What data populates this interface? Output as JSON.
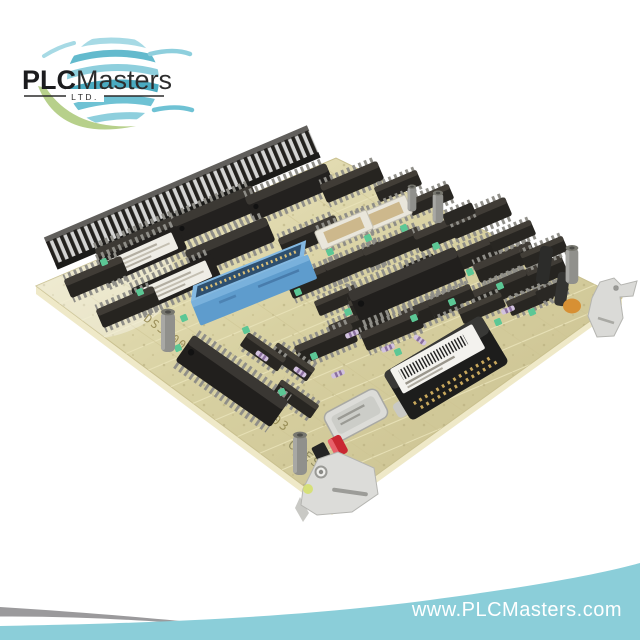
{
  "brand": {
    "logo": {
      "text_bold": "PLC",
      "text_regular": "Masters",
      "suffix": "LTD."
    },
    "website": "www.PLCMasters.com"
  },
  "board": {
    "markings": {
      "part_number": "DS3800HMPJ1A1D",
      "slot_code": "6BA03",
      "group_code": "C-ESS"
    }
  },
  "colors": {
    "background": "#ffffff",
    "banner_teal": "#8bced9",
    "swoosh_gray": "#9b9a9c",
    "logo_teal": "#63bacd",
    "logo_teal_light": "#a7dae5",
    "logo_teal_deep": "#4aabc1",
    "leaf_green": "#b7d08b",
    "logo_text": "#1d1d1f",
    "url_text": "#ffffff",
    "pcb_tan": "#d8d1a2",
    "connector_blue": "#5e9ccd",
    "chip_black": "#211f1d",
    "lever_gray": "#dcdcd9"
  }
}
